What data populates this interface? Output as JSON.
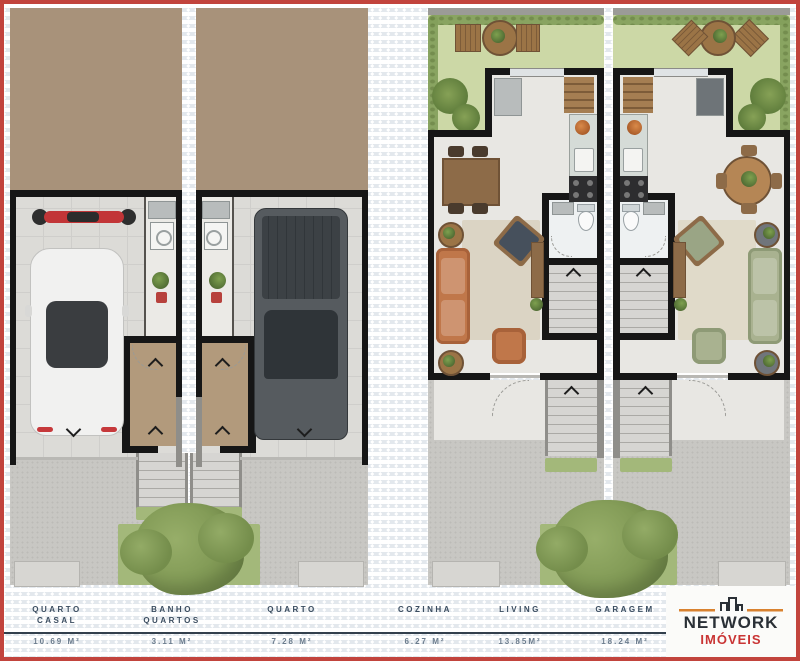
{
  "brand": {
    "name": "NETWORK",
    "segment": "IMÓVEIS"
  },
  "legend": {
    "items": [
      {
        "name": "QUARTO\nCASAL",
        "area": "10.69 M²"
      },
      {
        "name": "BANHO\nQUARTOS",
        "area": "3.11 M²"
      },
      {
        "name": "QUARTO",
        "area": "7.28 M²"
      },
      {
        "name": "COZINHA",
        "area": "6.27 M²"
      },
      {
        "name": "LIVING",
        "area": "13.85M²"
      },
      {
        "name": "GARAGEM",
        "area": "18.24 M²"
      }
    ]
  },
  "colors": {
    "frame_red": "#c2443d",
    "label_navy": "#3b4d60",
    "area_gray": "#6b7c8d",
    "logo_dark": "#2a3036",
    "logo_red": "#c93434",
    "logo_orange": "#d9822f",
    "roof_tan": "#a8927a",
    "garden_green": "#ccd8a6",
    "sofa_orange": "#c0774a",
    "sofa_green": "#a9b290"
  },
  "icons": {
    "logo_building": "city-skyline-icon",
    "stair_direction": "chevron-arrow"
  }
}
